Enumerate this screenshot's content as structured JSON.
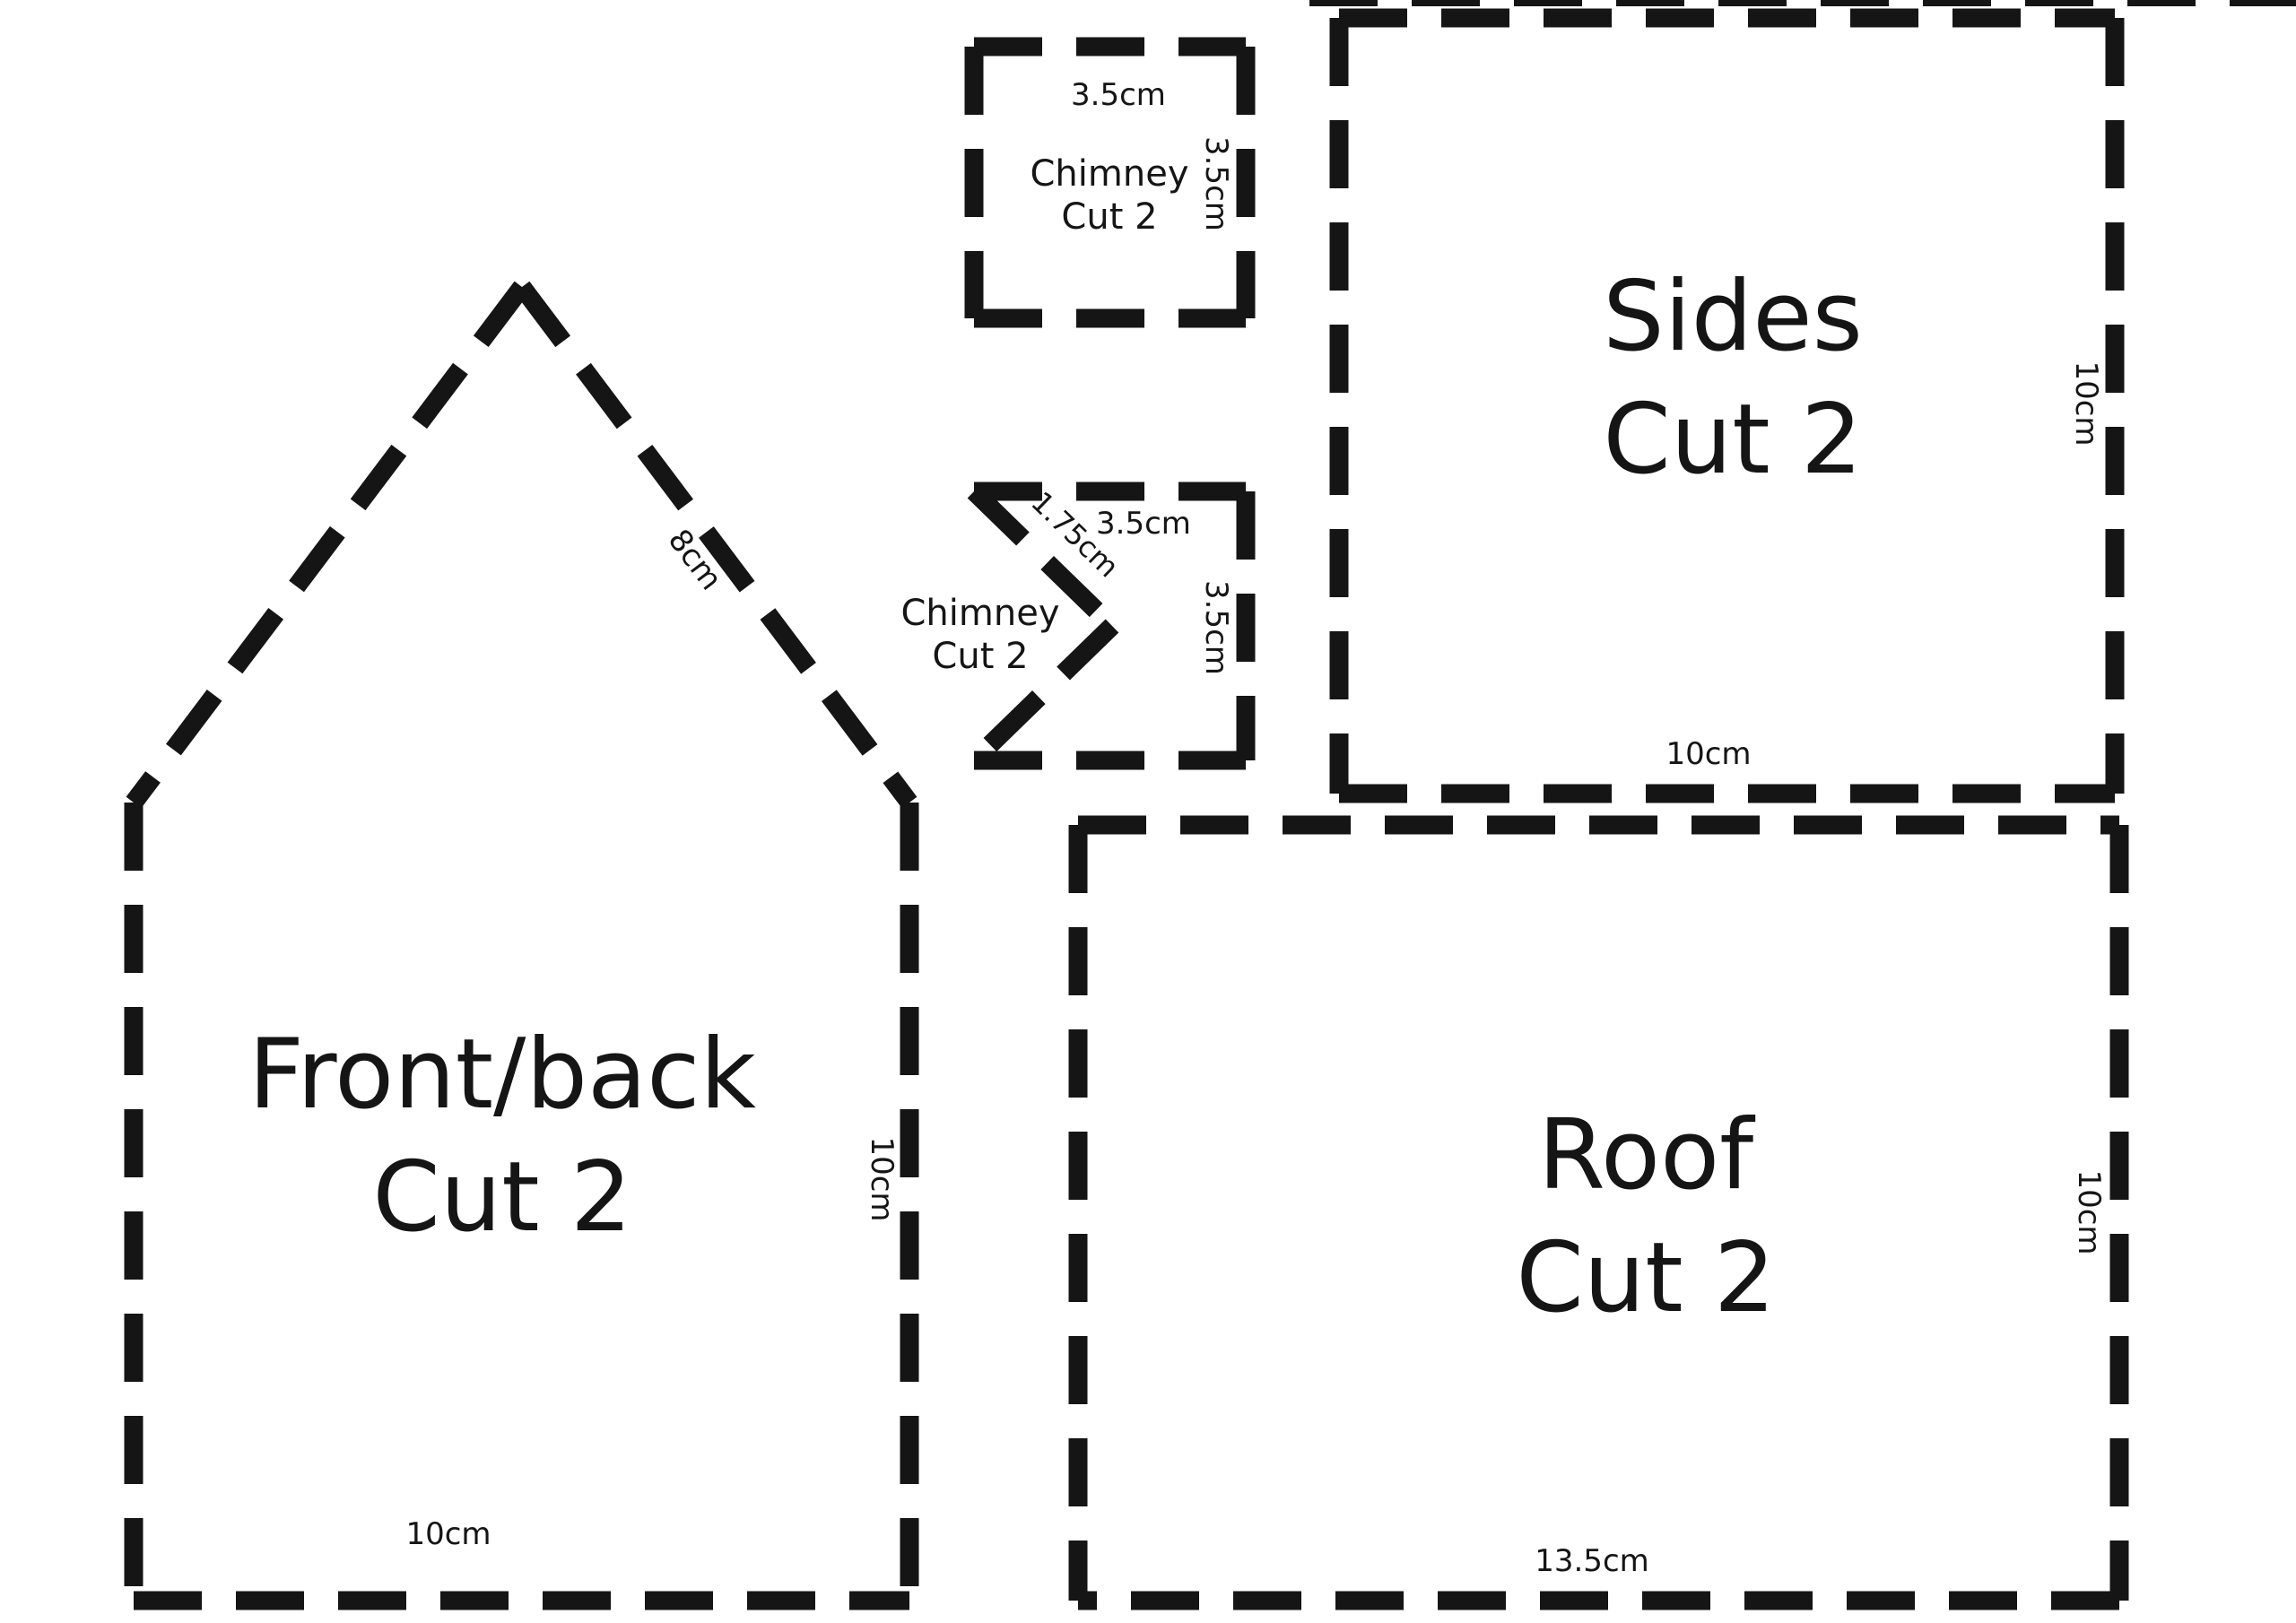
{
  "page": {
    "background_color": "#ffffff",
    "ink_color": "#151515",
    "description": "Gingerbread house cutting pattern with dashed cut lines"
  },
  "pieces": {
    "front_back": {
      "label_line1": "Front/back",
      "label_line2": "Cut 2",
      "dim_slope": "8cm",
      "dim_right": "10cm",
      "dim_bottom": "10cm"
    },
    "sides": {
      "label_line1": "Sides",
      "label_line2": "Cut 2",
      "dim_right": "10cm",
      "dim_bottom": "10cm"
    },
    "roof": {
      "label_line1": "Roof",
      "label_line2": "Cut 2",
      "dim_right": "10cm",
      "dim_bottom": "13.5cm"
    },
    "chimney_square": {
      "label_line1": "Chimney",
      "label_line2": "Cut 2",
      "dim_top": "3.5cm",
      "dim_right": "3.5cm"
    },
    "chimney_notched": {
      "label_line1": "Chimney",
      "label_line2": "Cut 2",
      "dim_top": "3.5cm",
      "dim_right": "3.5cm",
      "dim_notch": "1.75cm"
    }
  }
}
